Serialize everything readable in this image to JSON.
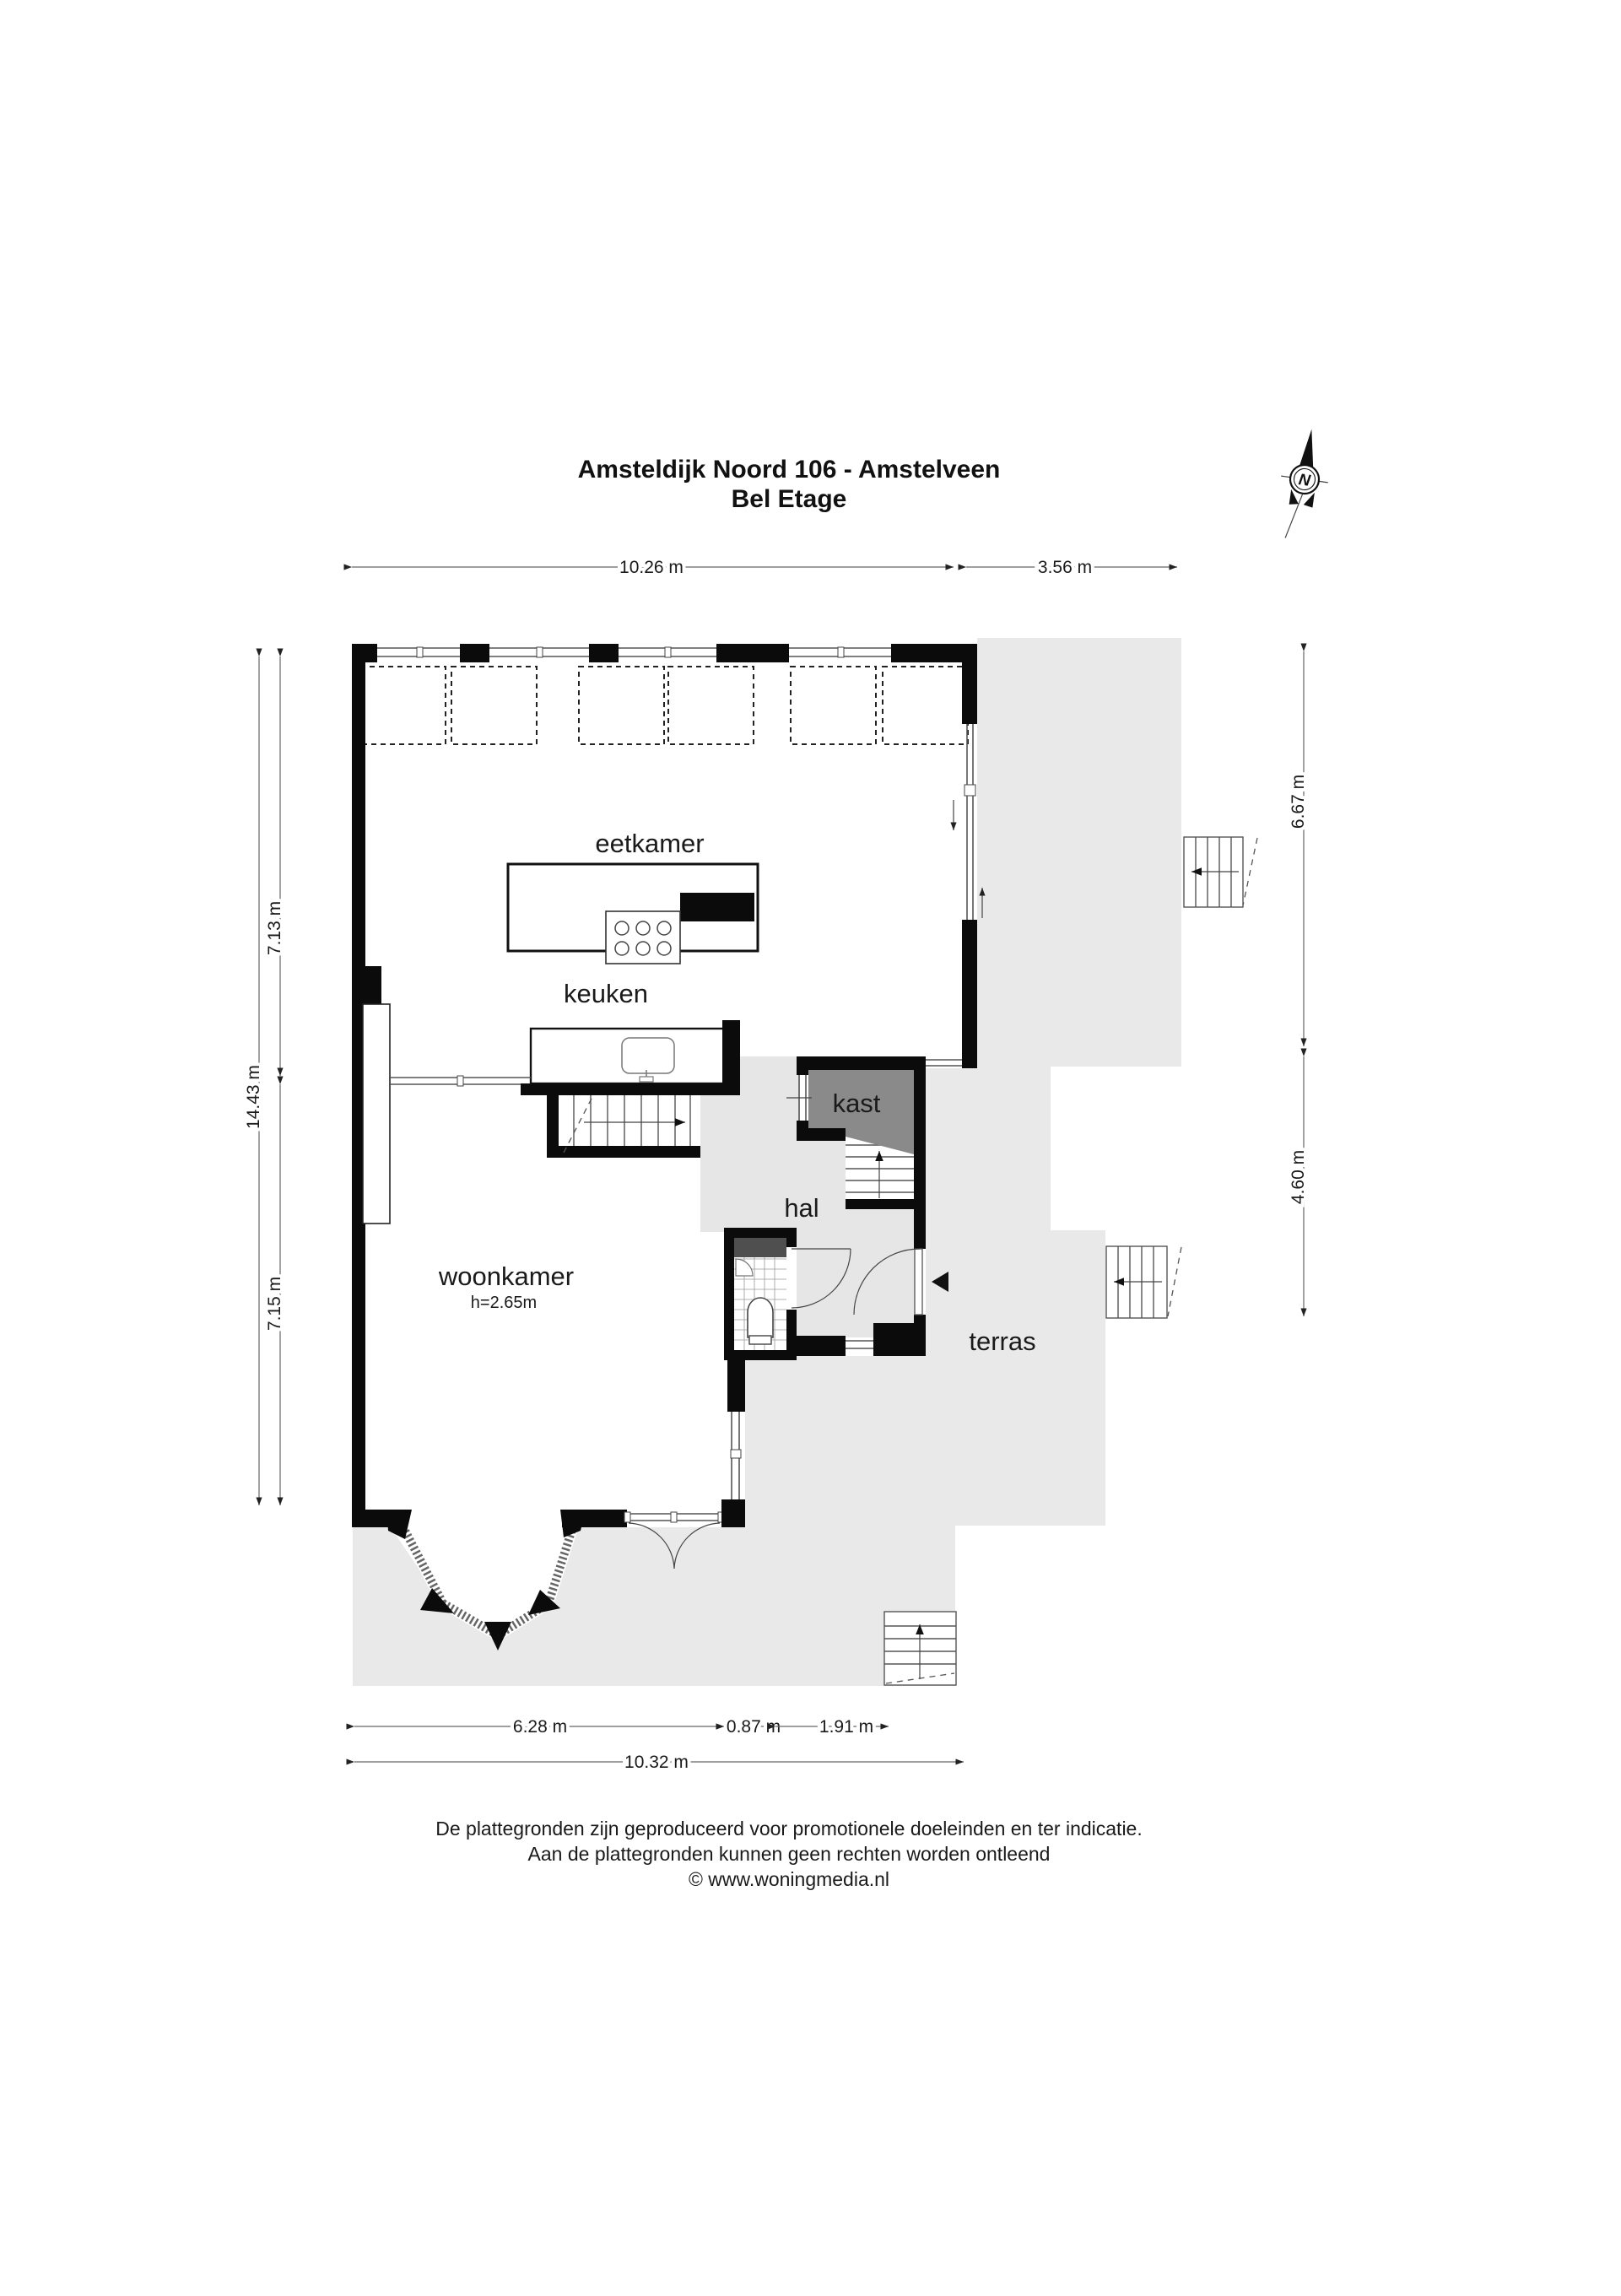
{
  "title": {
    "line1": "Amsteldijk Noord 106 - Amstelveen",
    "line2": "Bel Etage"
  },
  "compass": {
    "north_label": "N"
  },
  "rooms": {
    "eetkamer": "eetkamer",
    "keuken": "keuken",
    "kast": "kast",
    "hal": "hal",
    "woonkamer": "woonkamer",
    "woonkamer_height": "h=2.65m",
    "terras": "terras"
  },
  "dimensions": {
    "top_main": "10.26 m",
    "top_right": "3.56 m",
    "left_outer": "14.43 m",
    "left_upper": "7.13 m",
    "left_lower": "7.15 m",
    "right_upper": "6.67 m",
    "right_lower": "4.60 m",
    "bottom_left": "6.28 m",
    "bottom_mid": "0.87 m",
    "bottom_right": "1.91 m",
    "bottom_total": "10.32 m"
  },
  "footer": {
    "line1": "De plattegronden zijn geproduceerd voor promotionele doeleinden en ter indicatie.",
    "line2": "Aan de plattegronden kunnen geen rechten worden ontleend",
    "line3": "© www.woningmedia.nl"
  },
  "colors": {
    "wall": "#0b0b0b",
    "exterior_area": "#e9e9e9",
    "hall_area": "#e6e6e6",
    "closet_fill": "#8a8a8a",
    "fixture_dark": "#4f4f4f"
  }
}
